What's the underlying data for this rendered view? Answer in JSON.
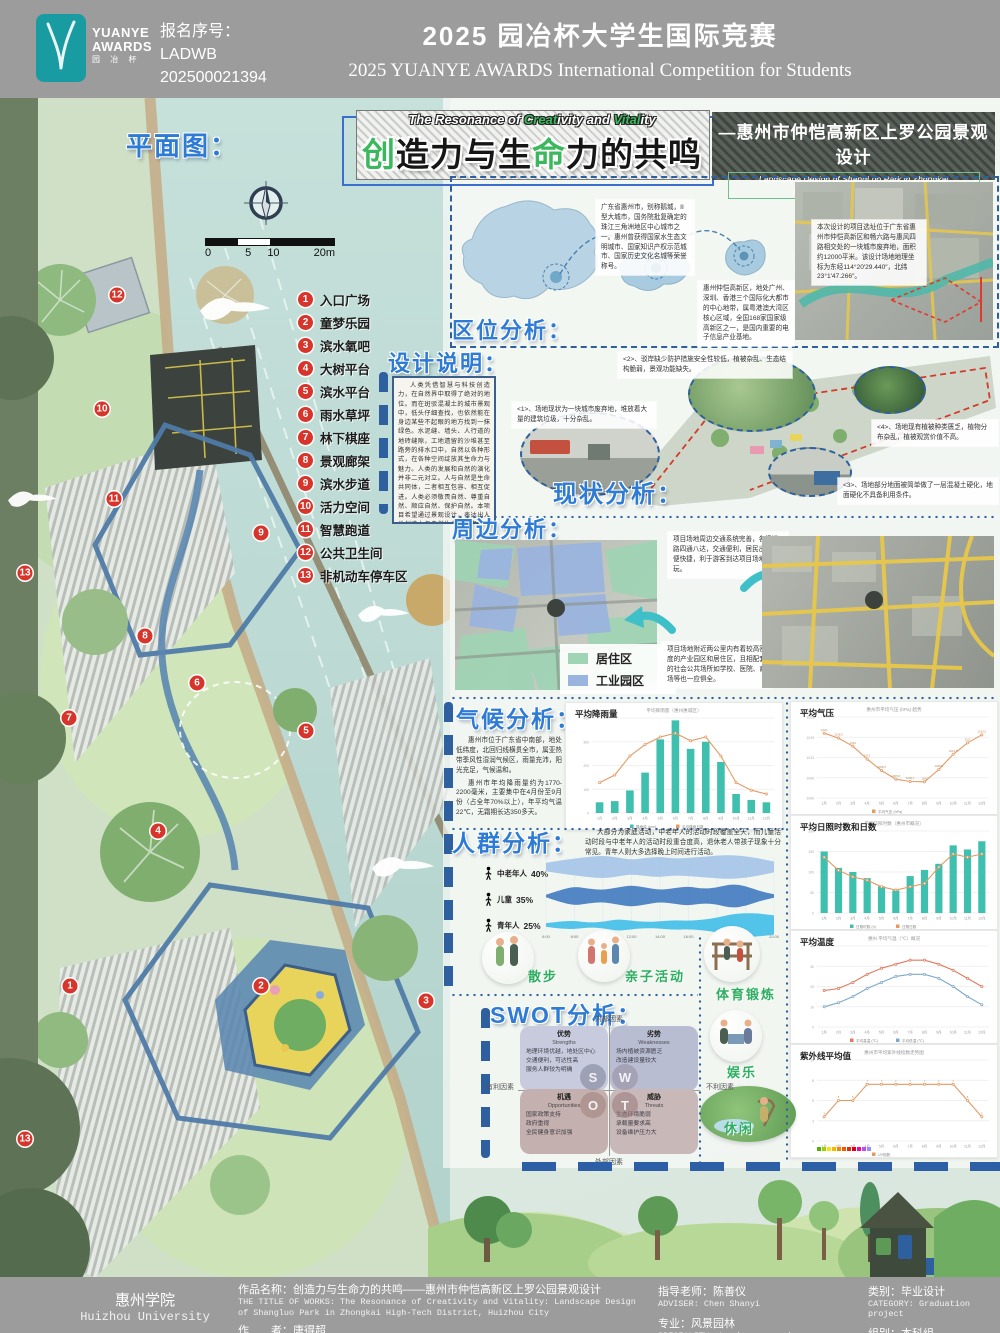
{
  "header": {
    "logo": {
      "line1": "YUANYE",
      "line2": "AWARDS",
      "line3": "园 冶 杯"
    },
    "reg_label": "报名序号：",
    "reg_code1": "LADWB",
    "reg_code2": "202500021394",
    "title_cn": "2025 园冶杯大学生国际竞赛",
    "title_en": "2025 YUANYE AWARDS International Competition for  Students"
  },
  "banner": {
    "plan_label": "平面图：",
    "eyebrow_parts": [
      {
        "t": "The Resonance of ",
        "c": "w"
      },
      {
        "t": "Creat",
        "c": "g"
      },
      {
        "t": "ivity and ",
        "c": "w"
      },
      {
        "t": "Vital",
        "c": "g"
      },
      {
        "t": "ity",
        "c": "w"
      }
    ],
    "title_parts": [
      {
        "t": "创",
        "c": "g"
      },
      {
        "t": "造力与生",
        "c": "w"
      },
      {
        "t": "命",
        "c": "g"
      },
      {
        "t": "力的共鸣",
        "c": "w"
      }
    ],
    "right_title": "—惠州市仲恺高新区上罗公园景观设计",
    "right_sub1": "Landscape Design of ShangLuo Park in Zhongkai",
    "right_sub2": "High-Tech District, Huizhou City"
  },
  "plan": {
    "scale_labels": [
      "0",
      "5",
      "10",
      "20m"
    ],
    "legend": [
      {
        "n": "1",
        "label": "入口广场"
      },
      {
        "n": "2",
        "label": "童梦乐园"
      },
      {
        "n": "3",
        "label": "滨水氧吧"
      },
      {
        "n": "4",
        "label": "大树平台"
      },
      {
        "n": "5",
        "label": "滨水平台"
      },
      {
        "n": "6",
        "label": "雨水草坪"
      },
      {
        "n": "7",
        "label": "林下棋座"
      },
      {
        "n": "8",
        "label": "景观廊架"
      },
      {
        "n": "9",
        "label": "滨水步道"
      },
      {
        "n": "10",
        "label": "活力空间"
      },
      {
        "n": "11",
        "label": "智慧跑道"
      },
      {
        "n": "12",
        "label": "公共卫生间"
      },
      {
        "n": "13",
        "label": "非机动车停车区"
      }
    ],
    "markers": [
      {
        "n": "12",
        "x": 117,
        "y": 295
      },
      {
        "n": "10",
        "x": 102,
        "y": 409
      },
      {
        "n": "11",
        "x": 114,
        "y": 499
      },
      {
        "n": "9",
        "x": 261,
        "y": 533
      },
      {
        "n": "13",
        "x": 25,
        "y": 573
      },
      {
        "n": "8",
        "x": 145,
        "y": 636
      },
      {
        "n": "6",
        "x": 197,
        "y": 683
      },
      {
        "n": "7",
        "x": 69,
        "y": 718
      },
      {
        "n": "5",
        "x": 306,
        "y": 731
      },
      {
        "n": "4",
        "x": 158,
        "y": 831
      },
      {
        "n": "1",
        "x": 70,
        "y": 986
      },
      {
        "n": "2",
        "x": 261,
        "y": 986
      },
      {
        "n": "3",
        "x": 426,
        "y": 1001
      },
      {
        "n": "13",
        "x": 25,
        "y": 1139
      }
    ]
  },
  "sections": {
    "quwei": {
      "title": "区位分析：",
      "t1": "广东省惠州市，别称鹅城，II型大城市，国务院批复确定的珠江三角洲地区中心城市之一。惠州曾获得国家水生态文明城市、国家知识产权示范城市、国家历史文化名城等荣誉称号。",
      "t2": "惠州仲恺高新区，地处广州、深圳、香港三个国际化大都市的中心地带，属粤港澳大湾区核心区域，全国168家国家级高新区之一，是国内重要的电子信息产业基地。",
      "t3": "本次设计的项目选址位于广东省惠州市仲恺高新区和畅六路与惠风四路相交处的一块城市废弃地，面积约12000平米。该设计场地地理坐标为东经114°20′29.440″，北纬23°1′47.266″。"
    },
    "sheji": {
      "title": "设计说明：",
      "body": "人类凭借智慧与科技创造力，在自然界中取得了绝对的地位。而在斑驳混凝土的城市景观中，低头仔细查找，也依然能在身边某些不起眼的地方找到一抹绿色。水泥缝、墙头、人行道的地砖缝隙，工地遗留的沙堆甚至路旁的排水口中，自然以各种形式，在各种空间绽放其生命力与魅力。人类的发展和自然的演化并非二元对立。人与自然是生命共同体，二者相互包容、相互促进。人类必须敬畏自然、尊重自然、顺应自然、保护自然。本项目希望通过景观设计，表达出人类创造力与自然生命力二者共鸣而迸发出的独特魅力，体现人与自然是生命共同体，探究人与自然和谐共生现代化。"
    },
    "xianzhuang": {
      "title": "现状分析：",
      "items": [
        "<1>、场地现状为一块城市废弃地，堆放着大量的建筑垃圾，十分杂乱。",
        "<2>、驳岸缺少防护措施安全性较低，植被杂乱、生态结构脆弱，景观功能缺失。",
        "<3>、场地部分地面被简单做了一层混凝土硬化，地面硬化不具备利用条件。",
        "<4>、场地现有植被种类匮乏，植物分布杂乱，植被观赏价值不高。"
      ]
    },
    "zhoubian": {
      "title": "周边分析：",
      "t1": "项目场地周边交通系统完善，各级道路四通八达，交通便利，居民出行方便快捷，利于游客到达项目场地游玩。",
      "t2": "项目场地附近两公里内有着较高密度的产业园区和居住区，且相配套的社会公共场所如学校、医院、商场等也一应俱全。",
      "legend": [
        {
          "label": "居住区",
          "color": "#9fd4b4"
        },
        {
          "label": "工业园区",
          "color": "#9ab4e0"
        }
      ]
    },
    "qihou": {
      "title": "气候分析：",
      "p1": "惠州市位于广东省中南部，地处低纬度，北回归线横贯全市，属亚热带季风性湿润气候区，雨量充沛，阳光充足，气候温和。",
      "p2": "惠州市年均降雨量约为1770-2200毫米，主要集中在4月份至9月份（占全年70%以上），年平均气温22℃，无霜期长达350多天。"
    },
    "renqun": {
      "title": "人群分析：",
      "body": "大部分为家庭活动，中老年人的活动时段覆盖全天，而儿童活动时段与中老年人的活动时段重合度高，退休老人带孩子现象十分常见。青年人则大多选择晚上时间进行活动。",
      "activities": [
        "散步",
        "亲子活动",
        "体育锻炼",
        "娱乐",
        "休闲"
      ]
    },
    "swot": {
      "title": "SWOT分析：",
      "axis_top": "内部因素",
      "axis_bottom": "外部因素",
      "axis_left": "有利因素",
      "axis_right": "不利因素",
      "letters": [
        "S",
        "W",
        "O",
        "T"
      ],
      "quadrants": [
        {
          "cn": "优势",
          "en": "Strengths",
          "items": [
            "地理环境优越，地处区中心",
            "交通便利，可达性高",
            "服务人群较为明确"
          ],
          "color": "#c7cbdd"
        },
        {
          "cn": "劣势",
          "en": "Weaknesses",
          "items": [
            "场内植被资源匮乏",
            "改造建设量较大"
          ],
          "color": "#b9bdd1"
        },
        {
          "cn": "机遇",
          "en": "Opportunities",
          "items": [
            "国家政策支持",
            "政府重视",
            "全民健身意识加强"
          ],
          "color": "#c4b0ae"
        },
        {
          "cn": "威胁",
          "en": "Threats",
          "items": [
            "生态环境脆弱",
            "承载量要求高",
            "设备维护压力大"
          ],
          "color": "#c9b8b8"
        }
      ]
    }
  },
  "chart_data": [
    {
      "id": "rainfall",
      "type": "bar",
      "render": "combo",
      "panel_label": "平均降雨量",
      "title": "平均降雨量（惠州惠城区）",
      "categories": [
        "1月",
        "2月",
        "3月",
        "4月",
        "5月",
        "6月",
        "7月",
        "8月",
        "9月",
        "10月",
        "11月",
        "12月"
      ],
      "ylim": [
        0,
        400
      ],
      "series": [
        {
          "name": "降雨量 (mm)",
          "kind": "bar",
          "color": "#3fbfae",
          "values": [
            45,
            50,
            95,
            170,
            310,
            390,
            270,
            300,
            215,
            80,
            55,
            45
          ]
        },
        {
          "name": "平均降雨日数",
          "kind": "line",
          "color": "#e59a63",
          "ylim2": [
            0,
            25
          ],
          "values": [
            8,
            10,
            15,
            18,
            20,
            21,
            19,
            20,
            15,
            8,
            6,
            5
          ]
        }
      ]
    },
    {
      "id": "pressure",
      "type": "line",
      "render": "combo",
      "panel_label": "平均气压",
      "title": "惠州市平均气压 (hPa) 趋势",
      "categories": [
        "1月",
        "2月",
        "3月",
        "4月",
        "5月",
        "6月",
        "7月",
        "8月",
        "9月",
        "10月",
        "11月",
        "12月"
      ],
      "ylim": [
        1000,
        1025
      ],
      "point_labels": true,
      "series": [
        {
          "name": "平均气压 (hPa)",
          "kind": "line",
          "color": "#e59a63",
          "values": [
            1020,
            1018.5,
            1016,
            1012,
            1008.5,
            1005.8,
            1005.1,
            1005,
            1008.8,
            1013.5,
            1017,
            1019.5
          ]
        }
      ]
    },
    {
      "id": "sunshine",
      "type": "bar",
      "render": "combo",
      "panel_label": "平均日照时数和日数",
      "title": "平均日照时数（惠州市概况）",
      "categories": [
        "1月",
        "2月",
        "3月",
        "4月",
        "5月",
        "6月",
        "7月",
        "8月",
        "9月",
        "10月",
        "11月",
        "12月"
      ],
      "ylim": [
        0,
        200
      ],
      "series": [
        {
          "name": "日照时数 (h)",
          "kind": "bar",
          "color": "#3fbfae",
          "values": [
            150,
            110,
            100,
            85,
            65,
            55,
            90,
            105,
            120,
            165,
            155,
            175
          ]
        },
        {
          "name": "日照日数",
          "kind": "line",
          "color": "#e59a63",
          "ylim2": [
            0,
            25
          ],
          "values": [
            17,
            13,
            11,
            10,
            8,
            7,
            8,
            9,
            14,
            18,
            17,
            18
          ]
        }
      ]
    },
    {
      "id": "temperature",
      "type": "line",
      "render": "combo",
      "panel_label": "平均温度",
      "title": "惠州 平均气温（℃）概况",
      "categories": [
        "1月",
        "2月",
        "3月",
        "4月",
        "5月",
        "6月",
        "7月",
        "8月",
        "9月",
        "10月",
        "11月",
        "12月"
      ],
      "ylim": [
        0,
        40
      ],
      "series": [
        {
          "name": "平均高温 (℃)",
          "kind": "line",
          "color": "#e07b5f",
          "values": [
            18,
            19,
            22,
            26,
            29,
            31,
            33,
            33,
            31,
            28,
            24,
            20
          ]
        },
        {
          "name": "平均低温 (℃)",
          "kind": "line",
          "color": "#7fa8c9",
          "values": [
            10,
            12,
            15,
            19,
            22,
            25,
            26,
            26,
            24,
            20,
            15,
            11
          ]
        }
      ]
    },
    {
      "id": "uv",
      "type": "line",
      "render": "combo",
      "panel_label": "紫外线平均值",
      "title": "惠州市平均紫外线指数走势图",
      "categories": [
        "1月",
        "2月",
        "3月",
        "4月",
        "5月",
        "6月",
        "7月",
        "8月",
        "9月",
        "10月",
        "11月",
        "12月"
      ],
      "ylim": [
        0,
        10
      ],
      "point_labels": true,
      "scale_colors": [
        "#4eb400",
        "#a0ce00",
        "#f7e400",
        "#f8b600",
        "#f88700",
        "#f85900",
        "#e82c0e",
        "#d8001d",
        "#ff0099",
        "#b54cff",
        "#998cff"
      ],
      "series": [
        {
          "name": "UV指数",
          "kind": "line",
          "color": "#e59a63",
          "values": [
            3,
            5,
            5,
            7,
            7,
            7,
            7,
            7,
            7,
            7,
            5,
            3
          ]
        }
      ]
    },
    {
      "id": "crowd",
      "type": "area",
      "render": "stream",
      "panel_label": "",
      "title": "",
      "x": [
        "6:00",
        "8:00",
        "10:00",
        "12:00",
        "14:00",
        "16:00",
        "18:00",
        "20:00",
        "22:00"
      ],
      "series": [
        {
          "name": "中老年人",
          "pct": "40%",
          "color": "#a8c6e8",
          "widths": [
            0.35,
            0.55,
            0.7,
            0.85,
            0.95,
            0.8,
            0.6,
            0.75,
            0.85,
            0.7,
            0.75,
            0.85,
            0.95,
            1.0,
            0.9,
            0.7,
            0.45
          ]
        },
        {
          "name": "儿童",
          "pct": "35%",
          "color": "#4a7fc1",
          "widths": [
            0.1,
            0.5,
            0.8,
            0.6,
            0.5,
            0.7,
            0.9,
            0.7,
            0.5,
            0.65,
            0.8,
            0.6,
            0.7,
            1.0,
            0.85,
            0.4,
            0.15
          ]
        },
        {
          "name": "青年人",
          "pct": "25%",
          "color": "#49c0e8",
          "widths": [
            0.15,
            0.3,
            0.35,
            0.2,
            0.25,
            0.5,
            0.35,
            0.25,
            0.3,
            0.4,
            0.35,
            0.45,
            0.6,
            0.9,
            1.0,
            0.95,
            0.8
          ]
        }
      ]
    }
  ],
  "footer": {
    "school_cn": "惠州学院",
    "school_en": "Huizhou University",
    "work_cn": "作品名称：创造力与生命力的共鸣——惠州市仲恺高新区上罗公园景观设计",
    "work_en": "THE TITLE OF WORKS: The Resonance of Creativity and Vitality: Landscape Design of Shangluo Park in Zhongkai High-Tech District, Huizhou City",
    "author_cn": "作　　者：唐得超",
    "author_en": "DESIGN TEAM& AUTHOR: Tang Dechao",
    "adviser_cn": "指导老师：陈善仪",
    "adviser_en": "ADVISER: Chen Shanyi",
    "major_cn": "专业：风景园林",
    "major_en": "SPECIALITY: Landscape gardens",
    "category_cn": "类别：毕业设计",
    "category_en": "CATEGORY: Graduation project",
    "group_cn": "组别：本科组",
    "group_en": "GROUP: Undergraduate group"
  },
  "colors": {
    "accent_blue": "#2d7bd4",
    "accent_green": "#3cb85c",
    "teal_logo": "#199ba2",
    "marker_red": "#d7352b",
    "dash_blue": "#2e5f9e",
    "bar_teal": "#3fbfae",
    "line_orange": "#e59a63"
  }
}
